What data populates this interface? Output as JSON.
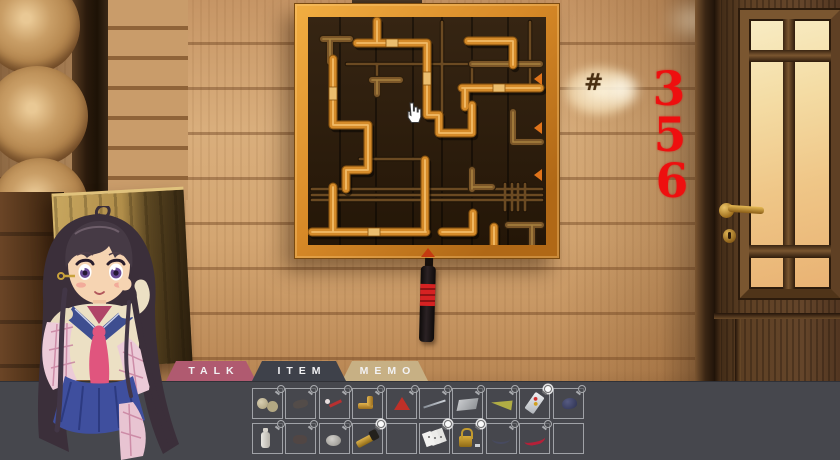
{
  "scene": {
    "wall_symbol": "#",
    "wall_numbers": [
      "3",
      "5",
      "6"
    ],
    "number_color": "#ee0f0f",
    "cursor": "hand-pointer"
  },
  "tabs": [
    {
      "id": "talk",
      "label": "TALK",
      "color": "#b05a70",
      "active": false
    },
    {
      "id": "item",
      "label": "ITEM",
      "color": "#3e414a",
      "active": true
    },
    {
      "id": "memo",
      "label": "MEMO",
      "color": "#c7b084",
      "active": false
    }
  ],
  "inventory": {
    "rows": 2,
    "cols": 10,
    "slots": [
      {
        "icon": "rope-spools",
        "magnifier": "gray"
      },
      {
        "icon": "faint-item",
        "magnifier": "gray"
      },
      {
        "icon": "red-screwdriver",
        "magnifier": "gray"
      },
      {
        "icon": "brass-elbow-pipe",
        "magnifier": "gray"
      },
      {
        "icon": "red-cone",
        "magnifier": "gray"
      },
      {
        "icon": "metal-rod",
        "magnifier": "gray"
      },
      {
        "icon": "gray-slab",
        "magnifier": "gray"
      },
      {
        "icon": "shoehorn",
        "magnifier": "gray"
      },
      {
        "icon": "remote-control",
        "magnifier": "white"
      },
      {
        "icon": "blue-cap",
        "magnifier": "gray"
      },
      {
        "icon": "white-bottle",
        "magnifier": "gray"
      },
      {
        "icon": "faint-item-2",
        "magnifier": "gray"
      },
      {
        "icon": "gray-stone",
        "magnifier": "gray"
      },
      {
        "icon": "flashlight",
        "magnifier": "white"
      },
      {
        "icon": "empty",
        "magnifier": null
      },
      {
        "icon": "playing-cards",
        "magnifier": "white"
      },
      {
        "icon": "padlock-key",
        "magnifier": "white"
      },
      {
        "icon": "dark-cord",
        "magnifier": "gray"
      },
      {
        "icon": "red-cable",
        "magnifier": "gray"
      },
      {
        "icon": "empty",
        "magnifier": null
      }
    ]
  }
}
